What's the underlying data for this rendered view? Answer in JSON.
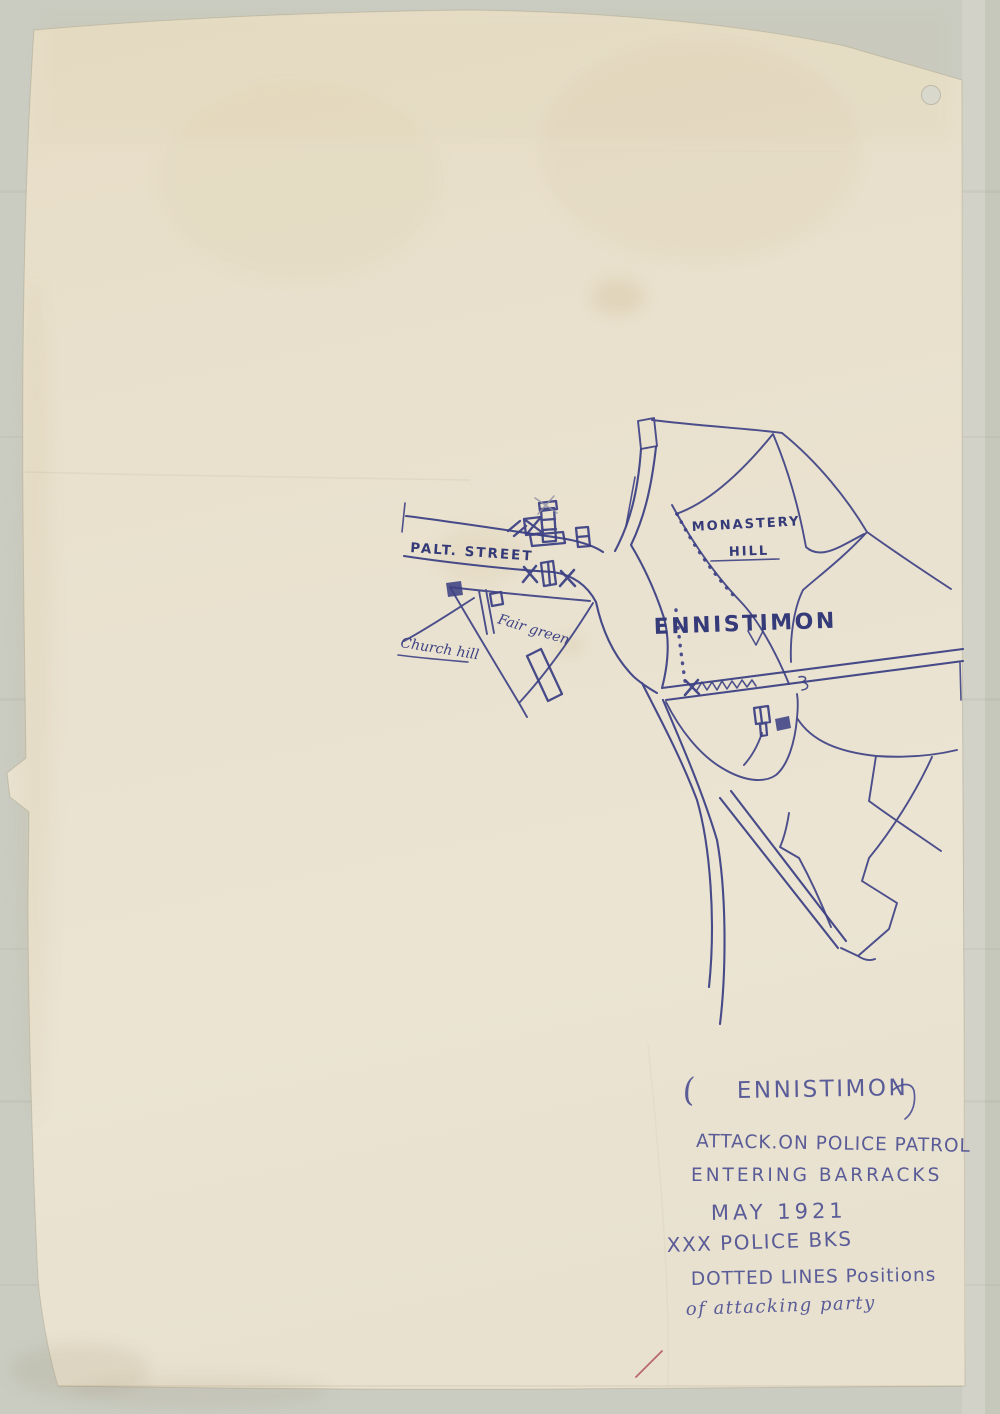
{
  "map": {
    "labels": {
      "street": "PALT. STREET",
      "monastery_hill_1": "MONASTERY",
      "monastery_hill_2": "HILL",
      "town": "ENNISTIMON",
      "church_hill": "Church hill",
      "fair_green": "Fair green"
    }
  },
  "caption": {
    "open_paren": "(",
    "title": "ENNISTIMON",
    "lines": [
      "ATTACK.ON POLICE PATROL",
      "ENTERING BARRACKS",
      "MAY  1921",
      "XXX POLICE BKS",
      "DOTTED LINES Positions",
      "of attacking party"
    ]
  },
  "colors": {
    "ink": "#3d4184",
    "caption_ink": "#4b4e92",
    "paper": "#e9e1ce",
    "background": "#caccc2",
    "red_mark": "#b0525a"
  }
}
